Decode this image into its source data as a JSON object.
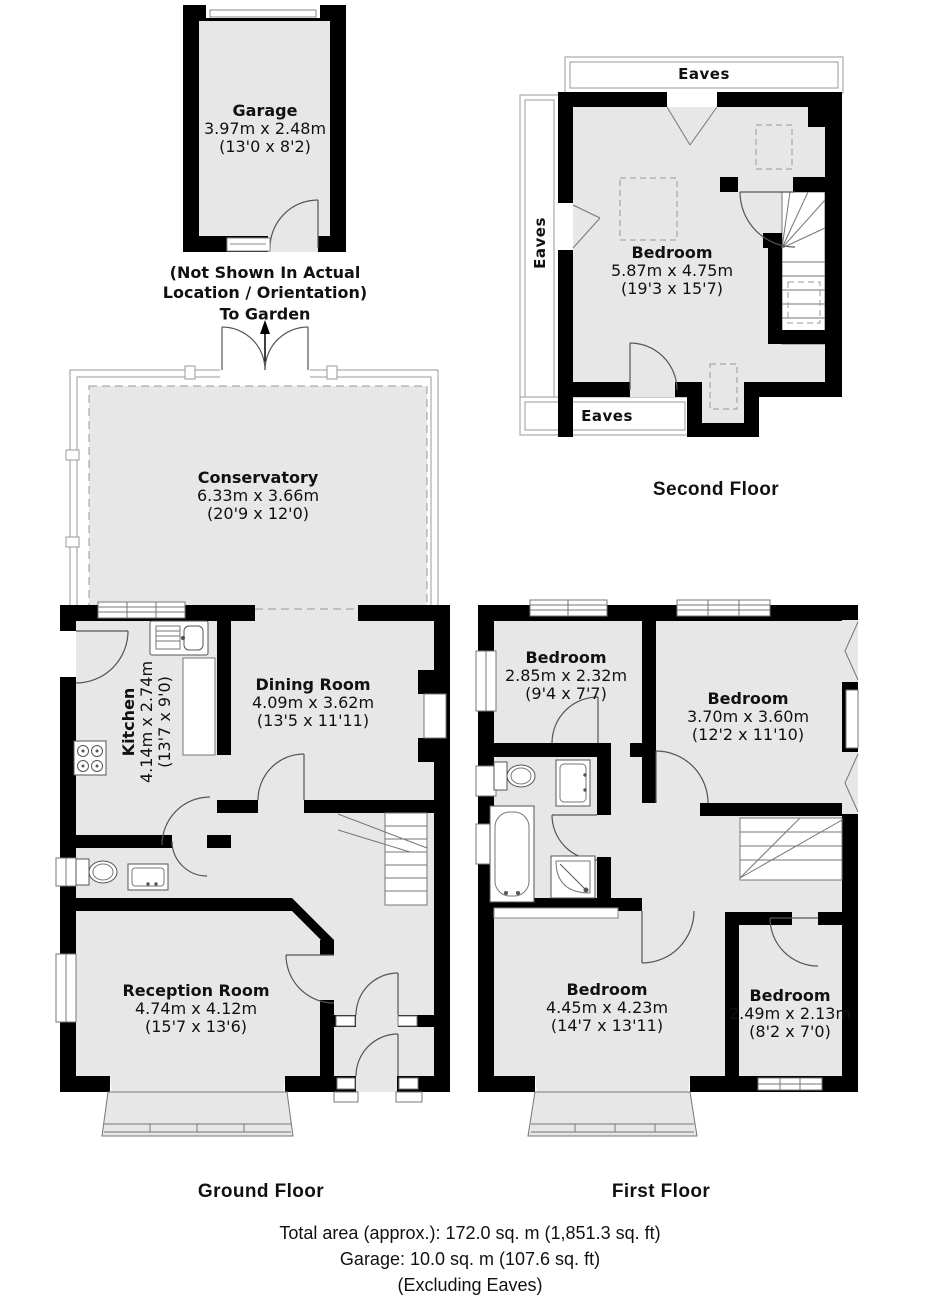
{
  "colors": {
    "floor_fill": "#e7e7e7",
    "wall": "#000000",
    "door_line": "#555555",
    "window_line": "#777777",
    "light_line": "#999999"
  },
  "garage": {
    "name": "Garage",
    "size_m": "3.97m x 2.48m",
    "size_ft": "(13'0 x 8'2)"
  },
  "garage_note": {
    "line1": "(Not Shown In Actual",
    "line2": "Location / Orientation)",
    "to_garden": "To Garden"
  },
  "ground_floor": {
    "title": "Ground Floor",
    "conservatory": {
      "name": "Conservatory",
      "size_m": "6.33m x 3.66m",
      "size_ft": "(20'9 x 12'0)"
    },
    "kitchen": {
      "name": "Kitchen",
      "size_m": "4.14m x 2.74m",
      "size_ft": "(13'7 x 9'0)"
    },
    "dining_room": {
      "name": "Dining Room",
      "size_m": "4.09m x 3.62m",
      "size_ft": "(13'5 x 11'11)"
    },
    "reception_room": {
      "name": "Reception Room",
      "size_m": "4.74m x 4.12m",
      "size_ft": "(15'7 x 13'6)"
    }
  },
  "first_floor": {
    "title": "First Floor",
    "bedroom_top_small": {
      "name": "Bedroom",
      "size_m": "2.85m x 2.32m",
      "size_ft": "(9'4 x 7'7)"
    },
    "bedroom_top_large": {
      "name": "Bedroom",
      "size_m": "3.70m x 3.60m",
      "size_ft": "(12'2 x 11'10)"
    },
    "bedroom_bottom_large": {
      "name": "Bedroom",
      "size_m": "4.45m x 4.23m",
      "size_ft": "(14'7 x 13'11)"
    },
    "bedroom_bottom_small": {
      "name": "Bedroom",
      "size_m": "2.49m x 2.13m",
      "size_ft": "(8'2 x 7'0)"
    }
  },
  "second_floor": {
    "title": "Second Floor",
    "bedroom": {
      "name": "Bedroom",
      "size_m": "5.87m x 4.75m",
      "size_ft": "(19'3 x 15'7)"
    },
    "eaves_top": "Eaves",
    "eaves_left": "Eaves",
    "eaves_bottom": "Eaves"
  },
  "footer": {
    "total_area": "Total area (approx.): 172.0 sq. m (1,851.3 sq. ft)",
    "garage_area": "Garage: 10.0 sq. m (107.6 sq. ft)",
    "excluding": "(Excluding Eaves)"
  }
}
